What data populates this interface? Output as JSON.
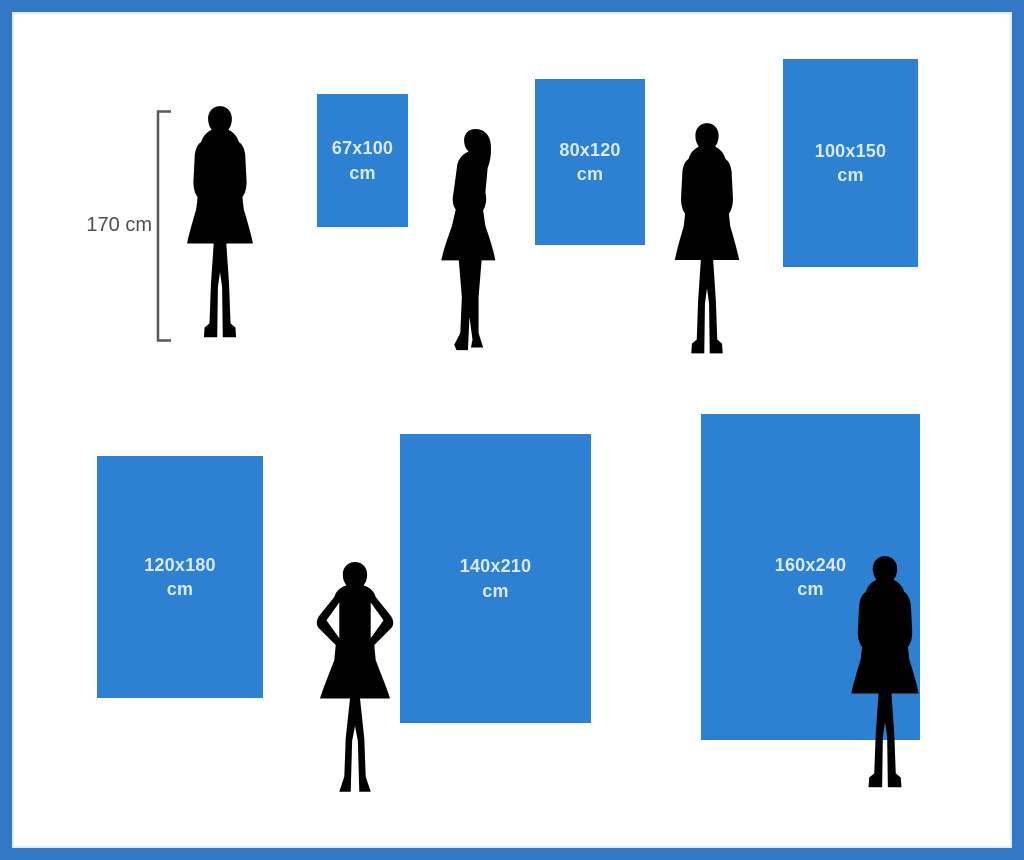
{
  "reference": {
    "height_label": "170 cm"
  },
  "sizes": [
    {
      "dims": "67x100",
      "unit": "cm"
    },
    {
      "dims": "80x120",
      "unit": "cm"
    },
    {
      "dims": "100x150",
      "unit": "cm"
    },
    {
      "dims": "120x180",
      "unit": "cm"
    },
    {
      "dims": "140x210",
      "unit": "cm"
    },
    {
      "dims": "160x240",
      "unit": "cm"
    }
  ],
  "colors": {
    "frame_border": "#3377c5",
    "rect_fill": "#2e80d2",
    "silhouette": "#8a8a8a",
    "rect_label": "#d8eafb",
    "reference_text": "#4f4f4f",
    "background": "#ffffff"
  }
}
